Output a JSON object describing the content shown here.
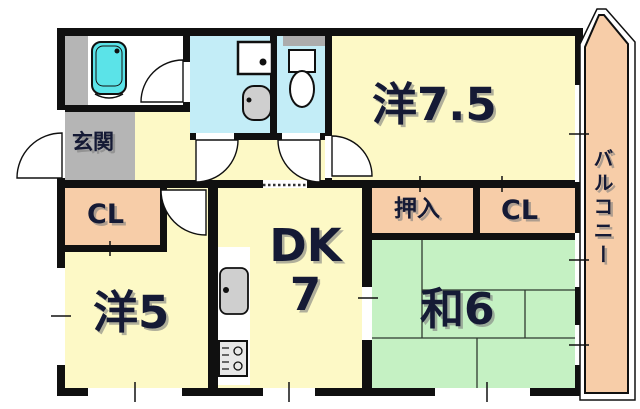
{
  "plan": {
    "rooms": {
      "genkan": "玄関",
      "western_7_5": "洋7.5",
      "balcony": "バルコニー",
      "closet_left": "CL",
      "oshiire": "押入",
      "closet_right": "CL",
      "western_5": "洋5",
      "dk": "DK",
      "dk_size": "7",
      "japanese_6": "和6"
    },
    "colors": {
      "room_yellow": "#fdf9c6",
      "water_blue": "#c3edf7",
      "tatami_green": "#c5f1c3",
      "closet_salmon": "#f7cda8",
      "entrance_gray": "#b5b5b5",
      "bathtub_cyan": "#5be3e8",
      "wall_black": "#101010",
      "label_navy": "#151a35"
    },
    "fixtures": [
      "bathtub",
      "washing-machine-pan",
      "washbasin",
      "toilet",
      "kitchen-sink",
      "stove"
    ]
  }
}
